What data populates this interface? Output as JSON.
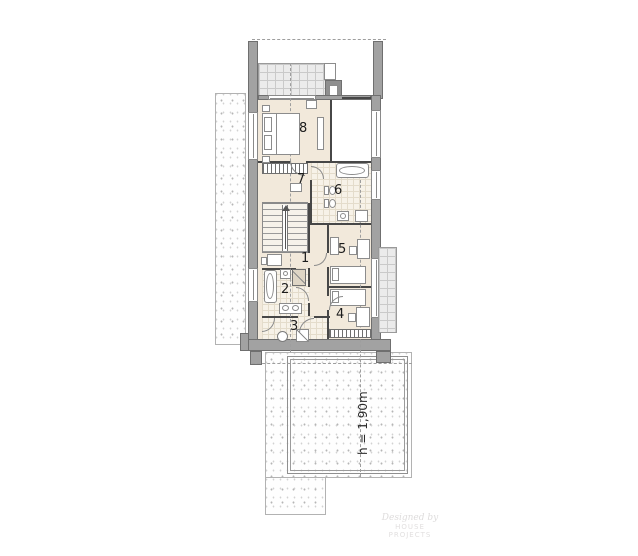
{
  "plan": {
    "type": "architectural floor plan, upper storey",
    "rooms": {
      "r1": {
        "label": "1"
      },
      "r2": {
        "label": "2"
      },
      "r3": {
        "label": "3"
      },
      "r4": {
        "label": "4"
      },
      "r5": {
        "label": "5"
      },
      "r6": {
        "label": "6"
      },
      "r7": {
        "label": "7"
      },
      "r8": {
        "label": "8"
      }
    },
    "annotations": {
      "height_note": "h = 1,90m"
    },
    "watermark": {
      "line1": "Designed by",
      "line2": "HOUSE PROJECTS"
    },
    "colors": {
      "wall_gray": "#a2a2a2",
      "room_beige": "#f2e9db",
      "tile_cream": "#f7f2e8",
      "line_dark": "#474747"
    }
  }
}
